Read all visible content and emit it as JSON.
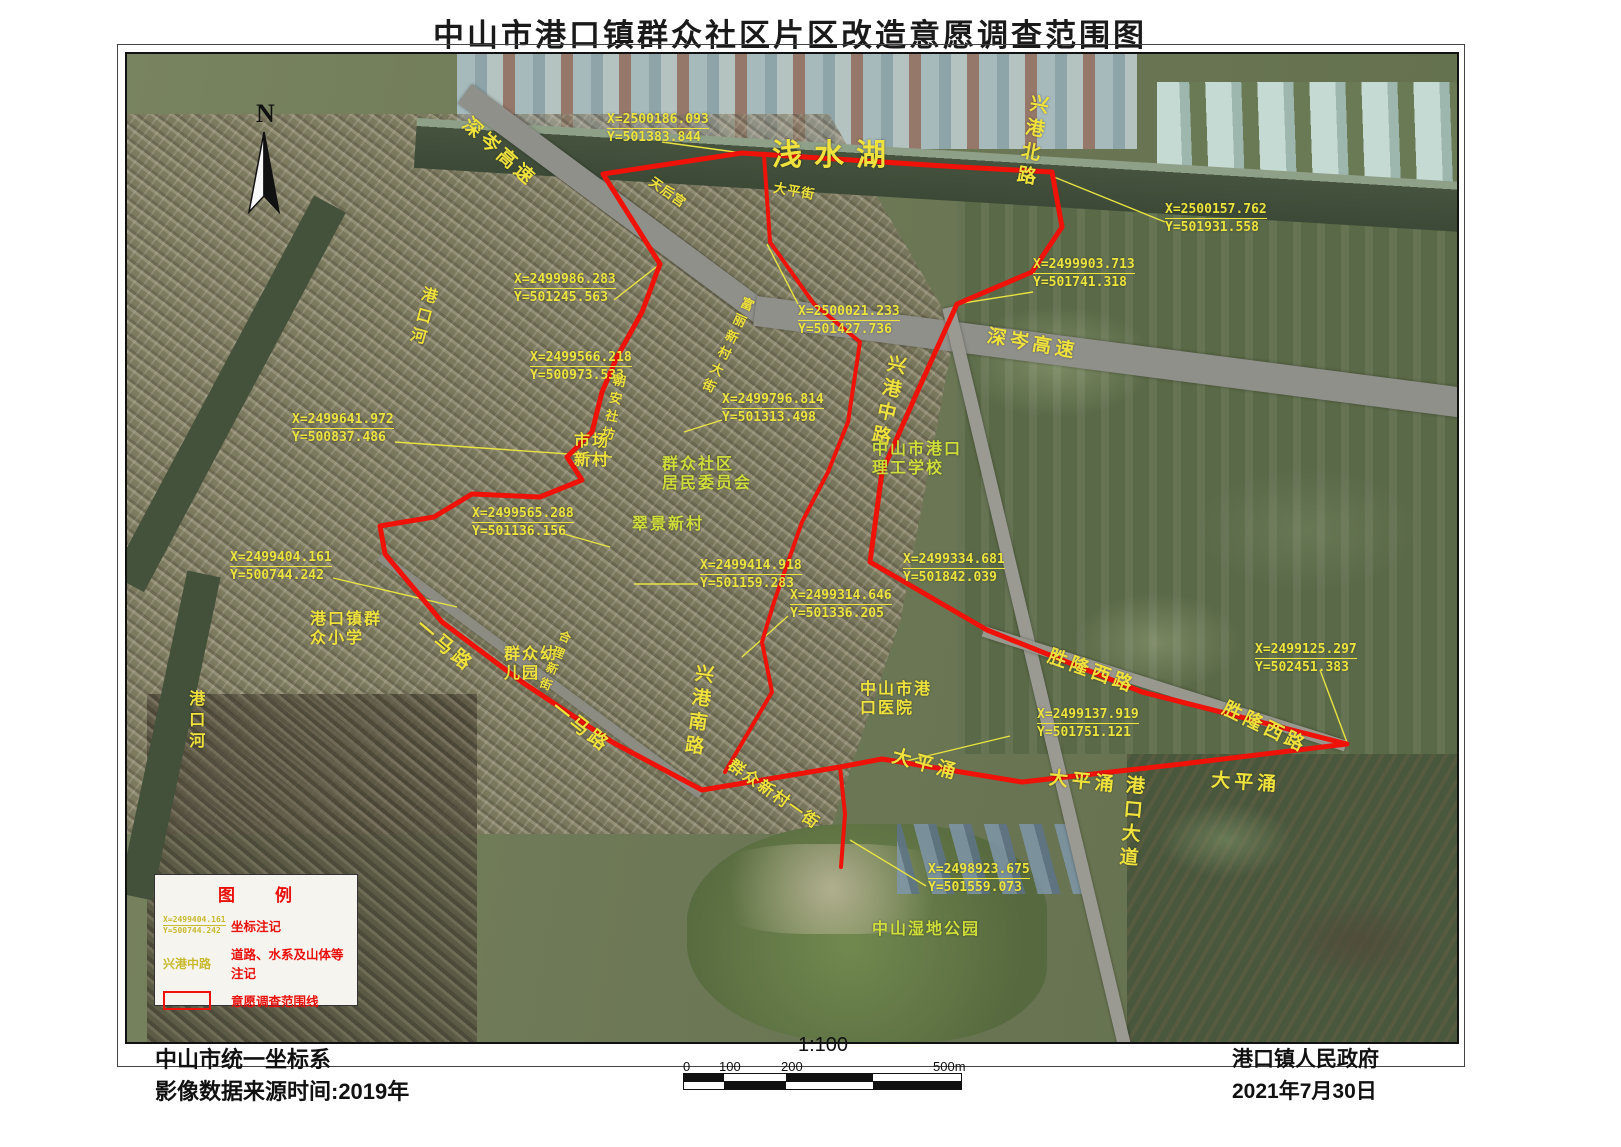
{
  "title": "中山市港口镇群众社区片区改造意愿调查范围图",
  "north_label": "N",
  "map": {
    "labels": [
      {
        "text": "浅水湖",
        "x": 645,
        "y": 84,
        "rot": 0,
        "cls": "water-xl"
      },
      {
        "text": "深岑高速",
        "x": 345,
        "y": 60,
        "rot": 42,
        "cls": "road-lg"
      },
      {
        "text": "深岑高速",
        "x": 862,
        "y": 272,
        "rot": 10,
        "cls": "road-lg"
      },
      {
        "text": "兴港北路",
        "x": 900,
        "y": 38,
        "rot": 10,
        "cls": "road-lg v"
      },
      {
        "text": "天后宫",
        "x": 528,
        "y": 120,
        "rot": 35,
        "cls": "road-sm"
      },
      {
        "text": "大平街",
        "x": 648,
        "y": 126,
        "rot": 10,
        "cls": "road-sm"
      },
      {
        "text": "港口河",
        "x": 293,
        "y": 230,
        "rot": 15,
        "cls": "road-md v"
      },
      {
        "text": "港口河",
        "x": 58,
        "y": 636,
        "rot": 0,
        "cls": "road-md v"
      },
      {
        "text": "富丽新村大街",
        "x": 615,
        "y": 240,
        "rot": 25,
        "cls": "road-sm v"
      },
      {
        "text": "兴港中路",
        "x": 758,
        "y": 298,
        "rot": 12,
        "cls": "road-lg v"
      },
      {
        "text": "中山市港口\n理工学校",
        "x": 745,
        "y": 386,
        "rot": 0,
        "cls": "road-md green"
      },
      {
        "text": "市场\n新村",
        "x": 447,
        "y": 378,
        "rot": 0,
        "cls": "road-md"
      },
      {
        "text": "群众社区\n居民委员会",
        "x": 535,
        "y": 401,
        "rot": 0,
        "cls": "road-md green"
      },
      {
        "text": "翠景新村",
        "x": 505,
        "y": 461,
        "rot": 0,
        "cls": "road-md green"
      },
      {
        "text": "朝安社坊",
        "x": 485,
        "y": 318,
        "rot": 12,
        "cls": "road-sm v"
      },
      {
        "text": "港口镇群\n众小学",
        "x": 183,
        "y": 556,
        "rot": 0,
        "cls": "road-md"
      },
      {
        "text": "群众幼\n儿园",
        "x": 377,
        "y": 591,
        "rot": 0,
        "cls": "road-md"
      },
      {
        "text": "合理新街",
        "x": 433,
        "y": 574,
        "rot": 22,
        "cls": "xs v"
      },
      {
        "text": "一马路",
        "x": 298,
        "y": 562,
        "rot": 40,
        "cls": "road-lg"
      },
      {
        "text": "一马路",
        "x": 433,
        "y": 644,
        "rot": 38,
        "cls": "road-lg"
      },
      {
        "text": "兴港南路",
        "x": 565,
        "y": 608,
        "rot": 8,
        "cls": "road-lg v"
      },
      {
        "text": "群众新村一街",
        "x": 608,
        "y": 702,
        "rot": 35,
        "cls": "road-md"
      },
      {
        "text": "大平涌",
        "x": 768,
        "y": 692,
        "rot": 15,
        "cls": "road-lg"
      },
      {
        "text": "大平涌",
        "x": 923,
        "y": 714,
        "rot": 6,
        "cls": "road-lg"
      },
      {
        "text": "大平涌",
        "x": 1085,
        "y": 716,
        "rot": 4,
        "cls": "road-lg"
      },
      {
        "text": "港口大道",
        "x": 995,
        "y": 720,
        "rot": 5,
        "cls": "road-lg v"
      },
      {
        "text": "中山市港\n口医院",
        "x": 733,
        "y": 626,
        "rot": 0,
        "cls": "road-md"
      },
      {
        "text": "胜隆西路",
        "x": 925,
        "y": 592,
        "rot": 20,
        "cls": "road-lg"
      },
      {
        "text": "胜隆西路",
        "x": 1101,
        "y": 644,
        "rot": 26,
        "cls": "road-lg"
      },
      {
        "text": "中山湿地公园",
        "x": 745,
        "y": 866,
        "rot": 0,
        "cls": "road-md green"
      }
    ],
    "coordinates": [
      {
        "x": "X=2500186.093",
        "y": "Y=501383.844",
        "px": 480,
        "py": 58,
        "leader": [
          [
            535,
            88
          ],
          [
            615,
            99
          ]
        ]
      },
      {
        "x": "X=2500157.762",
        "y": "Y=501931.558",
        "px": 1038,
        "py": 148,
        "leader": [
          [
            1038,
            168
          ],
          [
            927,
            123
          ]
        ]
      },
      {
        "x": "X=2499986.283",
        "y": "Y=501245.563",
        "px": 387,
        "py": 218,
        "leader": [
          [
            487,
            246
          ],
          [
            533,
            210
          ]
        ]
      },
      {
        "x": "X=2499903.713",
        "y": "Y=501741.318",
        "px": 906,
        "py": 203,
        "leader": [
          [
            906,
            238
          ],
          [
            830,
            250
          ]
        ]
      },
      {
        "x": "X=2500021.233",
        "y": "Y=501427.736",
        "px": 671,
        "py": 250,
        "leader": [
          [
            671,
            250
          ],
          [
            640,
            190
          ]
        ]
      },
      {
        "x": "X=2499566.218",
        "y": "Y=500973.533",
        "px": 403,
        "py": 296,
        "leader": [
          [
            478,
            324
          ],
          [
            515,
            258
          ]
        ]
      },
      {
        "x": "X=2499796.814",
        "y": "Y=501313.498",
        "px": 595,
        "py": 338,
        "leader": [
          [
            595,
            366
          ],
          [
            557,
            378
          ]
        ]
      },
      {
        "x": "X=2499641.972",
        "y": "Y=500837.486",
        "px": 165,
        "py": 358,
        "leader": [
          [
            268,
            388
          ],
          [
            485,
            403
          ]
        ]
      },
      {
        "x": "X=2499565.288",
        "y": "Y=501136.156",
        "px": 345,
        "py": 452,
        "leader": [
          [
            437,
            480
          ],
          [
            483,
            493
          ]
        ]
      },
      {
        "x": "X=2499404.161",
        "y": "Y=500744.242",
        "px": 103,
        "py": 496,
        "leader": [
          [
            206,
            524
          ],
          [
            330,
            553
          ]
        ]
      },
      {
        "x": "X=2499414.918",
        "y": "Y=501159.283",
        "px": 573,
        "py": 504,
        "leader": [
          [
            571,
            530
          ],
          [
            507,
            530
          ]
        ]
      },
      {
        "x": "X=2499334.681",
        "y": "Y=501842.039",
        "px": 776,
        "py": 498,
        "leader": [
          [
            774,
            526
          ],
          [
            745,
            510
          ]
        ]
      },
      {
        "x": "X=2499314.646",
        "y": "Y=501336.205",
        "px": 663,
        "py": 534,
        "leader": [
          [
            661,
            562
          ],
          [
            615,
            603
          ]
        ]
      },
      {
        "x": "X=2499125.297",
        "y": "Y=502451.383",
        "px": 1128,
        "py": 588,
        "leader": [
          [
            1193,
            616
          ],
          [
            1221,
            691
          ]
        ]
      },
      {
        "x": "X=2499137.919",
        "y": "Y=501751.121",
        "px": 910,
        "py": 653,
        "leader": [
          [
            883,
            682
          ],
          [
            775,
            708
          ]
        ]
      },
      {
        "x": "X=2498923.675",
        "y": "Y=501559.073",
        "px": 801,
        "py": 808,
        "leader": [
          [
            799,
            832
          ],
          [
            723,
            786
          ]
        ]
      }
    ],
    "routes": [
      {
        "cls": "route",
        "points": [
          [
            476,
            120
          ],
          [
            615,
            99
          ],
          [
            833,
            113
          ],
          [
            925,
            118
          ],
          [
            935,
            173
          ],
          [
            905,
            218
          ],
          [
            830,
            250
          ],
          [
            788,
            343
          ],
          [
            755,
            418
          ],
          [
            743,
            508
          ],
          [
            860,
            576
          ],
          [
            1015,
            638
          ],
          [
            1220,
            690
          ],
          [
            1055,
            710
          ],
          [
            895,
            728
          ],
          [
            755,
            705
          ],
          [
            713,
            713
          ],
          [
            575,
            736
          ],
          [
            485,
            688
          ],
          [
            395,
            628
          ],
          [
            315,
            568
          ],
          [
            258,
            500
          ],
          [
            253,
            472
          ],
          [
            307,
            463
          ],
          [
            345,
            440
          ],
          [
            413,
            443
          ],
          [
            455,
            426
          ],
          [
            440,
            403
          ],
          [
            465,
            378
          ],
          [
            475,
            338
          ],
          [
            490,
            303
          ],
          [
            515,
            258
          ],
          [
            533,
            210
          ],
          [
            476,
            120
          ]
        ]
      },
      {
        "cls": "route thin",
        "points": [
          [
            637,
            101
          ],
          [
            643,
            188
          ],
          [
            687,
            250
          ],
          [
            733,
            288
          ],
          [
            721,
            368
          ],
          [
            701,
            418
          ],
          [
            675,
            468
          ],
          [
            661,
            508
          ],
          [
            647,
            548
          ],
          [
            635,
            588
          ],
          [
            645,
            638
          ],
          [
            598,
            718
          ]
        ]
      },
      {
        "cls": "route thin",
        "points": [
          [
            713,
            713
          ],
          [
            718,
            760
          ],
          [
            714,
            813
          ]
        ]
      }
    ]
  },
  "legend": {
    "title": "图　　例",
    "items": [
      {
        "sample_x": "X=2499404.161",
        "sample_y": "Y=500744.242",
        "label": "坐标注记"
      },
      {
        "sample": "兴港中路",
        "label": "道路、水系及山体等注记"
      },
      {
        "label": "意愿调查范围线"
      }
    ]
  },
  "footer": {
    "left_line1": "中山市统一坐标系",
    "left_line2": "影像数据来源时间:2019年",
    "scale_ratio": "1:100",
    "scale_ticks": [
      {
        "t": "0",
        "dx": 0
      },
      {
        "t": "100",
        "dx": 36
      },
      {
        "t": "200",
        "dx": 98
      },
      {
        "t": "500m",
        "dx": 250
      }
    ],
    "scale_segments": [
      {
        "w": 40,
        "c1": "#111",
        "c2": "#fff"
      },
      {
        "w": 62,
        "c1": "#fff",
        "c2": "#111"
      },
      {
        "w": 87,
        "c1": "#111",
        "c2": "#fff"
      },
      {
        "w": 88,
        "c1": "#fff",
        "c2": "#111"
      }
    ],
    "right_line1": "港口镇人民政府",
    "right_line2": "2021年7月30日"
  }
}
